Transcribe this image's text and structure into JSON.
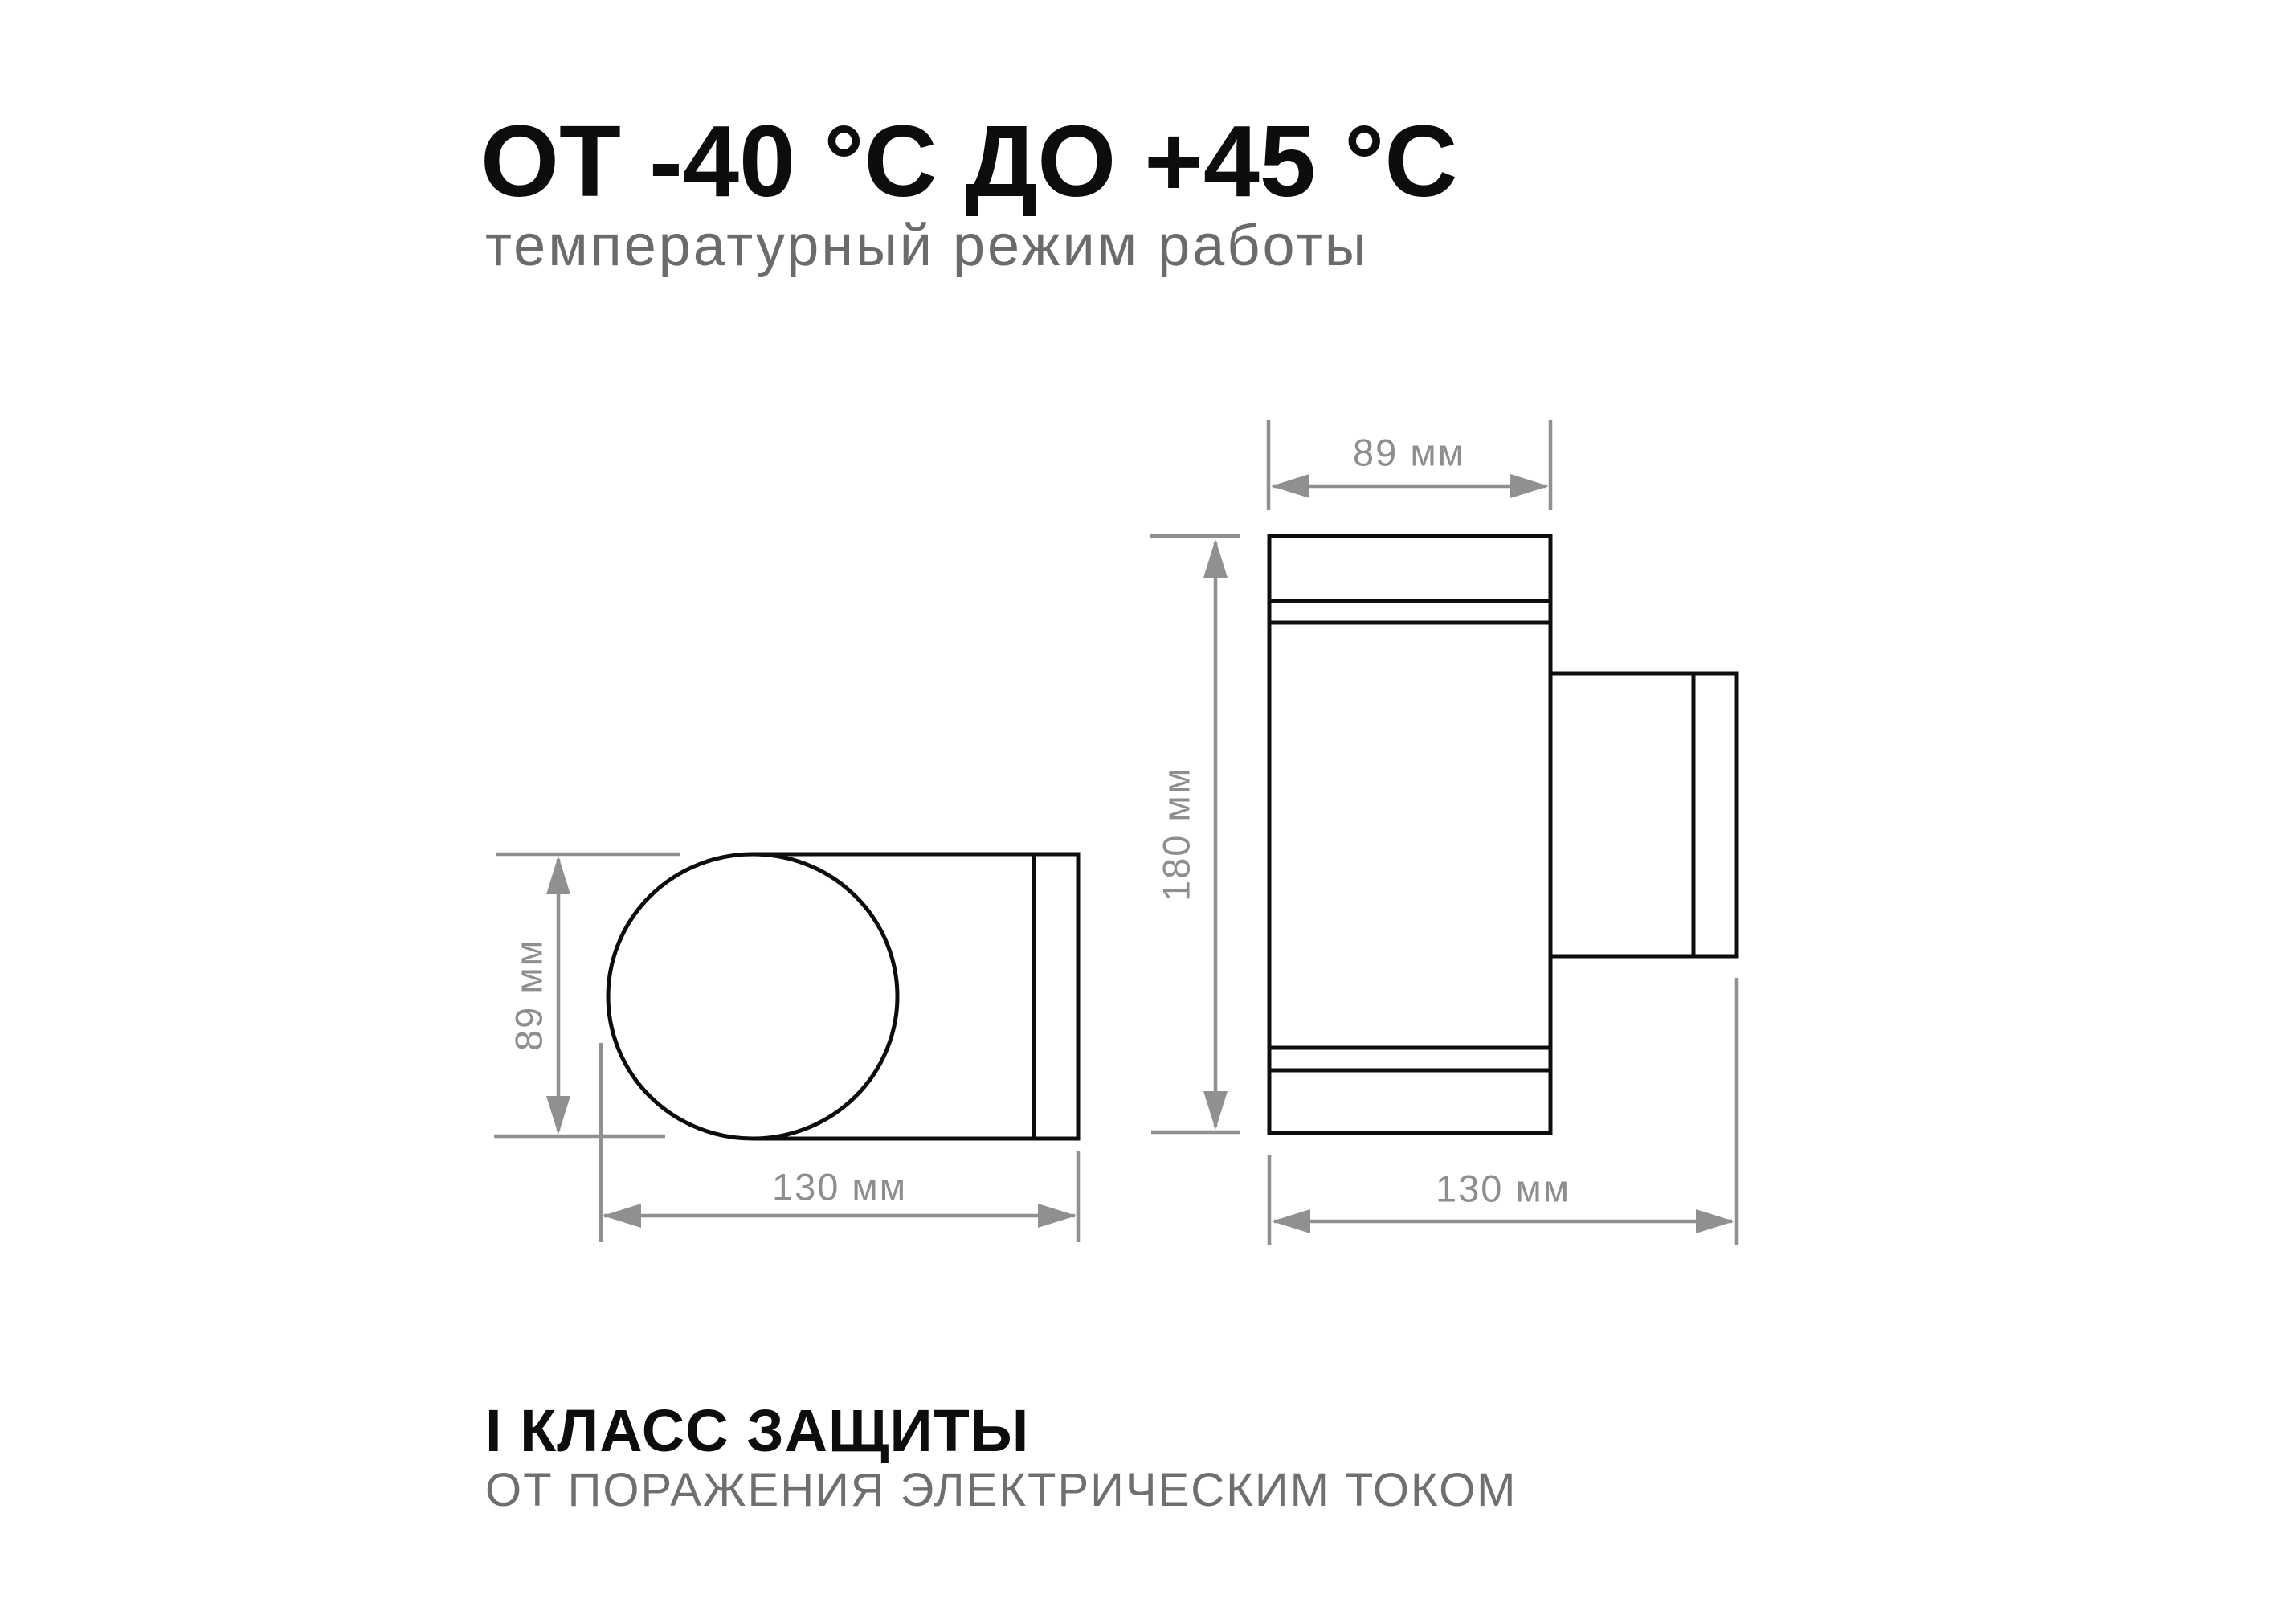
{
  "header": {
    "title": "ОТ -40 °С ДО +45 °С",
    "subtitle": "температурный режим работы"
  },
  "drawing": {
    "type": "technical-dimension-drawing",
    "colors": {
      "outline_black": "#0d0d0d",
      "dimension_gray": "#909090",
      "label_gray": "#8e8e8e",
      "background": "#ffffff"
    },
    "side_view": {
      "name": "side view of cylindrical wall light",
      "height_label": "89 мм",
      "width_label": "130 мм"
    },
    "front_view": {
      "name": "front view of wall light with mounting bracket",
      "width_label": "89 мм",
      "height_label": "180 мм",
      "depth_label": "130 мм"
    }
  },
  "footer": {
    "title": "I КЛАСС ЗАЩИТЫ",
    "subtitle": "ОТ ПОРАЖЕНИЯ ЭЛЕКТРИЧЕСКИМ ТОКОМ"
  }
}
